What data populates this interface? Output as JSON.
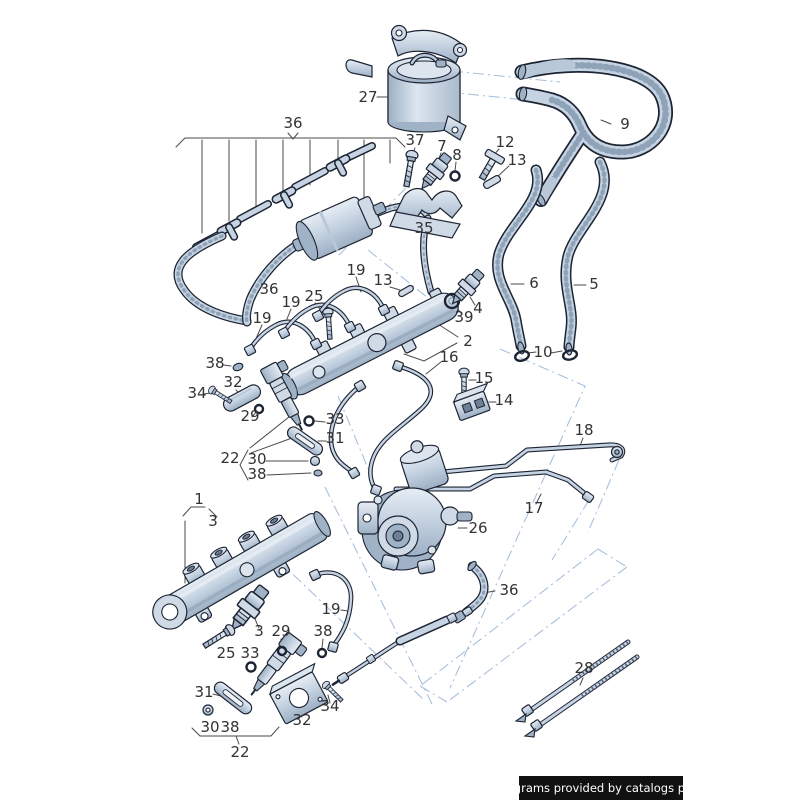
{
  "diagram": {
    "type": "exploded-parts-diagram",
    "subject": "fuel injection system: fuel rails, injectors, high-pressure pump, fuel lines and hoses"
  },
  "callouts": {
    "1": "1",
    "2": "2",
    "3": "3",
    "4": "4",
    "5": "5",
    "6": "6",
    "7": "7",
    "8": "8",
    "9": "9",
    "10": "10",
    "12": "12",
    "13": "13",
    "14": "14",
    "15": "15",
    "16": "16",
    "17": "17",
    "18": "18",
    "19": "19",
    "22": "22",
    "25": "25",
    "26": "26",
    "27": "27",
    "28": "28",
    "29": "29",
    "30": "30",
    "31": "31",
    "32": "32",
    "33": "33",
    "34": "34",
    "35": "35",
    "36": "36",
    "37": "37",
    "38": "38",
    "39": "39"
  },
  "footer": {
    "text": "Diagrams provided by catalogs parts"
  },
  "colors": {
    "background": "#ffffff",
    "part_fill": "#c6d3e2",
    "part_highlight": "#dce5ee",
    "part_shadow": "#9fb2c6",
    "outline": "#1d2433",
    "zone_line": "#a8c0dc",
    "label_text": "#333333",
    "footer_bg": "#111111",
    "footer_text": "#ffffff"
  }
}
